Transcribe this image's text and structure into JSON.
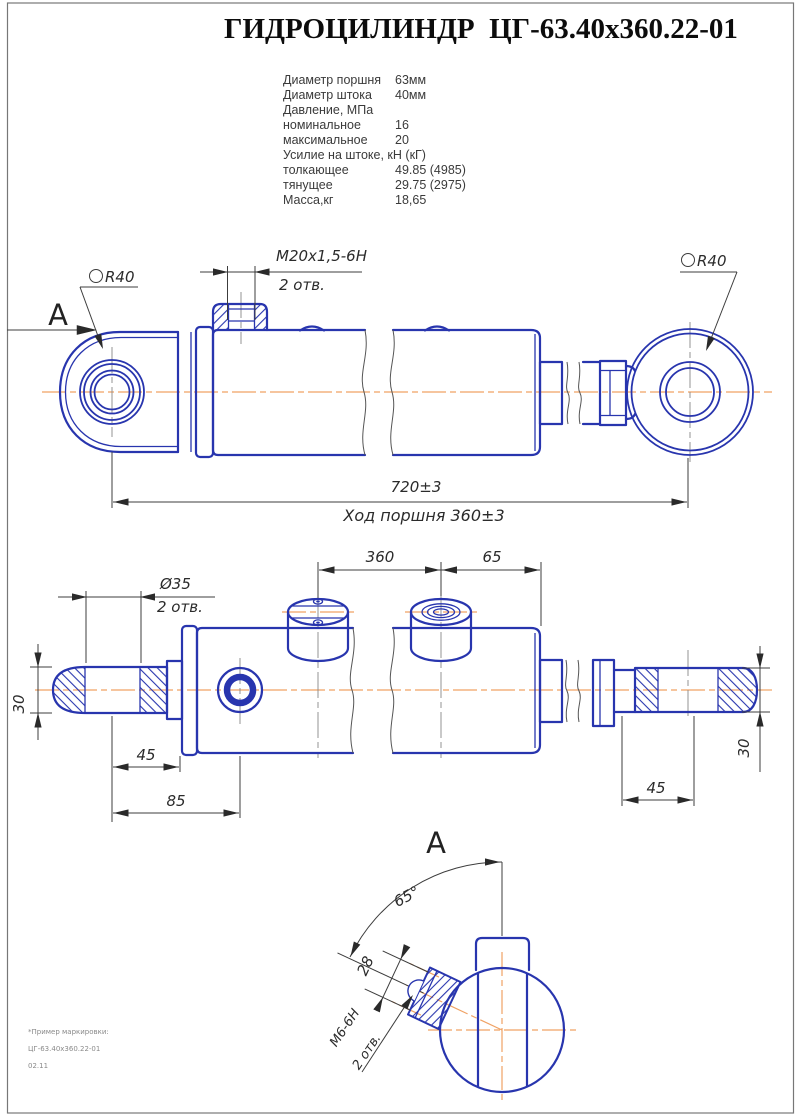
{
  "title": "ГИДРОЦИЛИНДР  ЦГ-63.40х360.22-01",
  "specs": {
    "rows": [
      {
        "label": "Диаметр поршня",
        "value": "63мм"
      },
      {
        "label": "Диаметр штока",
        "value": "40мм"
      },
      {
        "label": "Давление, МПа",
        "value": ""
      },
      {
        "label": "номинальное",
        "value": "16"
      },
      {
        "label": "максимальное",
        "value": "20"
      },
      {
        "label": "Усилие на штоке, кН (кГ)",
        "value": ""
      },
      {
        "label": "толкающее",
        "value": "49.85 (4985)"
      },
      {
        "label": "тянущее",
        "value": "29.75 (2975)"
      },
      {
        "label": "Масса,кг",
        "value": "18,65"
      }
    ]
  },
  "side_view": {
    "section_label": "А",
    "sphere_left": "R40",
    "sphere_right": "R40",
    "thread_label": "М20х1,5-6Н",
    "thread_qty": "2 отв.",
    "length_dim": "720±3",
    "stroke_dim": "Ход поршня 360±3"
  },
  "plan_view": {
    "hole_label": "Ø35",
    "hole_qty": "2 отв.",
    "dim_360": "360",
    "dim_65": "65",
    "dim_30_left": "30",
    "dim_45_left": "45",
    "dim_85": "85",
    "dim_45_right": "45",
    "dim_30_right": "30"
  },
  "view_a": {
    "label": "А",
    "angle_dim": "65°",
    "dim_28": "28",
    "thread_label": "М6-6Н",
    "thread_qty": "2 отв."
  },
  "footnote": {
    "line1": "*Пример маркировки:",
    "line2": "ЦГ-63.40х360.22-01",
    "line3": "02.11"
  },
  "colors": {
    "line_blue": "#2835ae",
    "centerline_orange": "#f0a264",
    "dim_dark": "#2b2b2b"
  }
}
